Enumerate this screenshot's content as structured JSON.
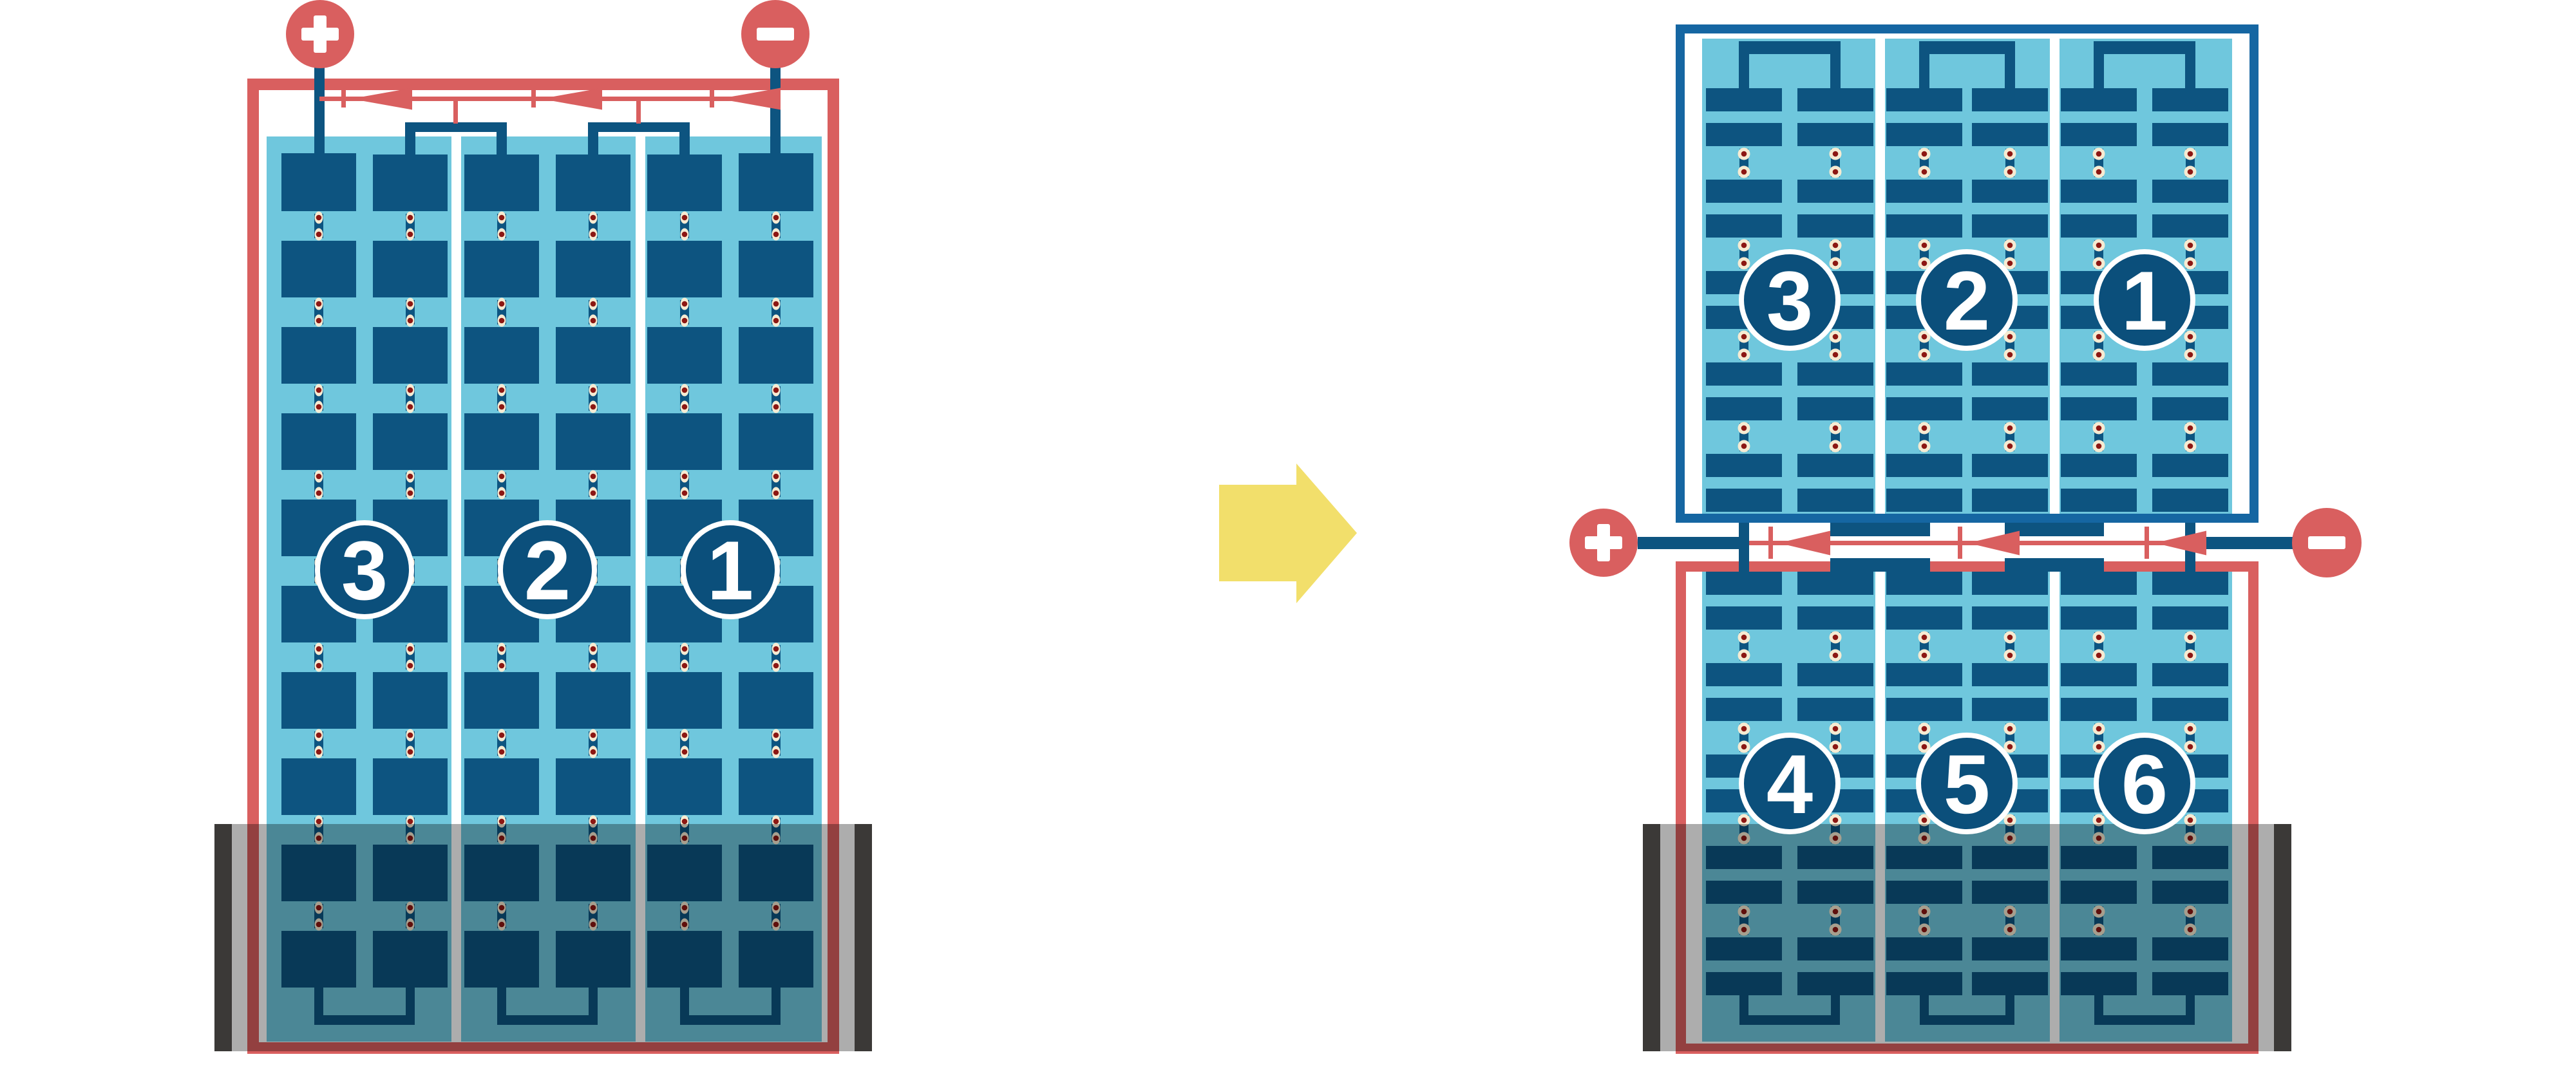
{
  "diagram": {
    "background": "#FFFFFF",
    "colors": {
      "red": "#D95F5F",
      "dark_blue": "#0D5480",
      "frame_blue": "#1566A2",
      "light_blue": "#6FC7DD",
      "cream": "#F6EBD2",
      "dot_red": "#8C1713",
      "badge_blue": "#0B4F7B",
      "case_black": "#3B3937",
      "overlay": "rgba(0,0,0,0.32)",
      "arrow_yellow": "#F2DF6B",
      "white": "#FFFFFF"
    },
    "left_battery": {
      "groups": 3,
      "plate_columns": 6,
      "plate_rows": 10,
      "cell_labels": [
        "3",
        "2",
        "1"
      ],
      "positive_terminal": "+",
      "negative_terminal": "−"
    },
    "right_battery": {
      "top_unit": {
        "groups": 3,
        "plate_columns": 6,
        "plate_rows": 10,
        "cell_labels": [
          "3",
          "2",
          "1"
        ]
      },
      "bottom_unit": {
        "groups": 3,
        "plate_columns": 6,
        "plate_rows": 10,
        "cell_labels": [
          "4",
          "5",
          "6"
        ]
      },
      "positive_terminal": "+",
      "negative_terminal": "−"
    },
    "transform_arrow": {
      "direction": "right"
    }
  }
}
